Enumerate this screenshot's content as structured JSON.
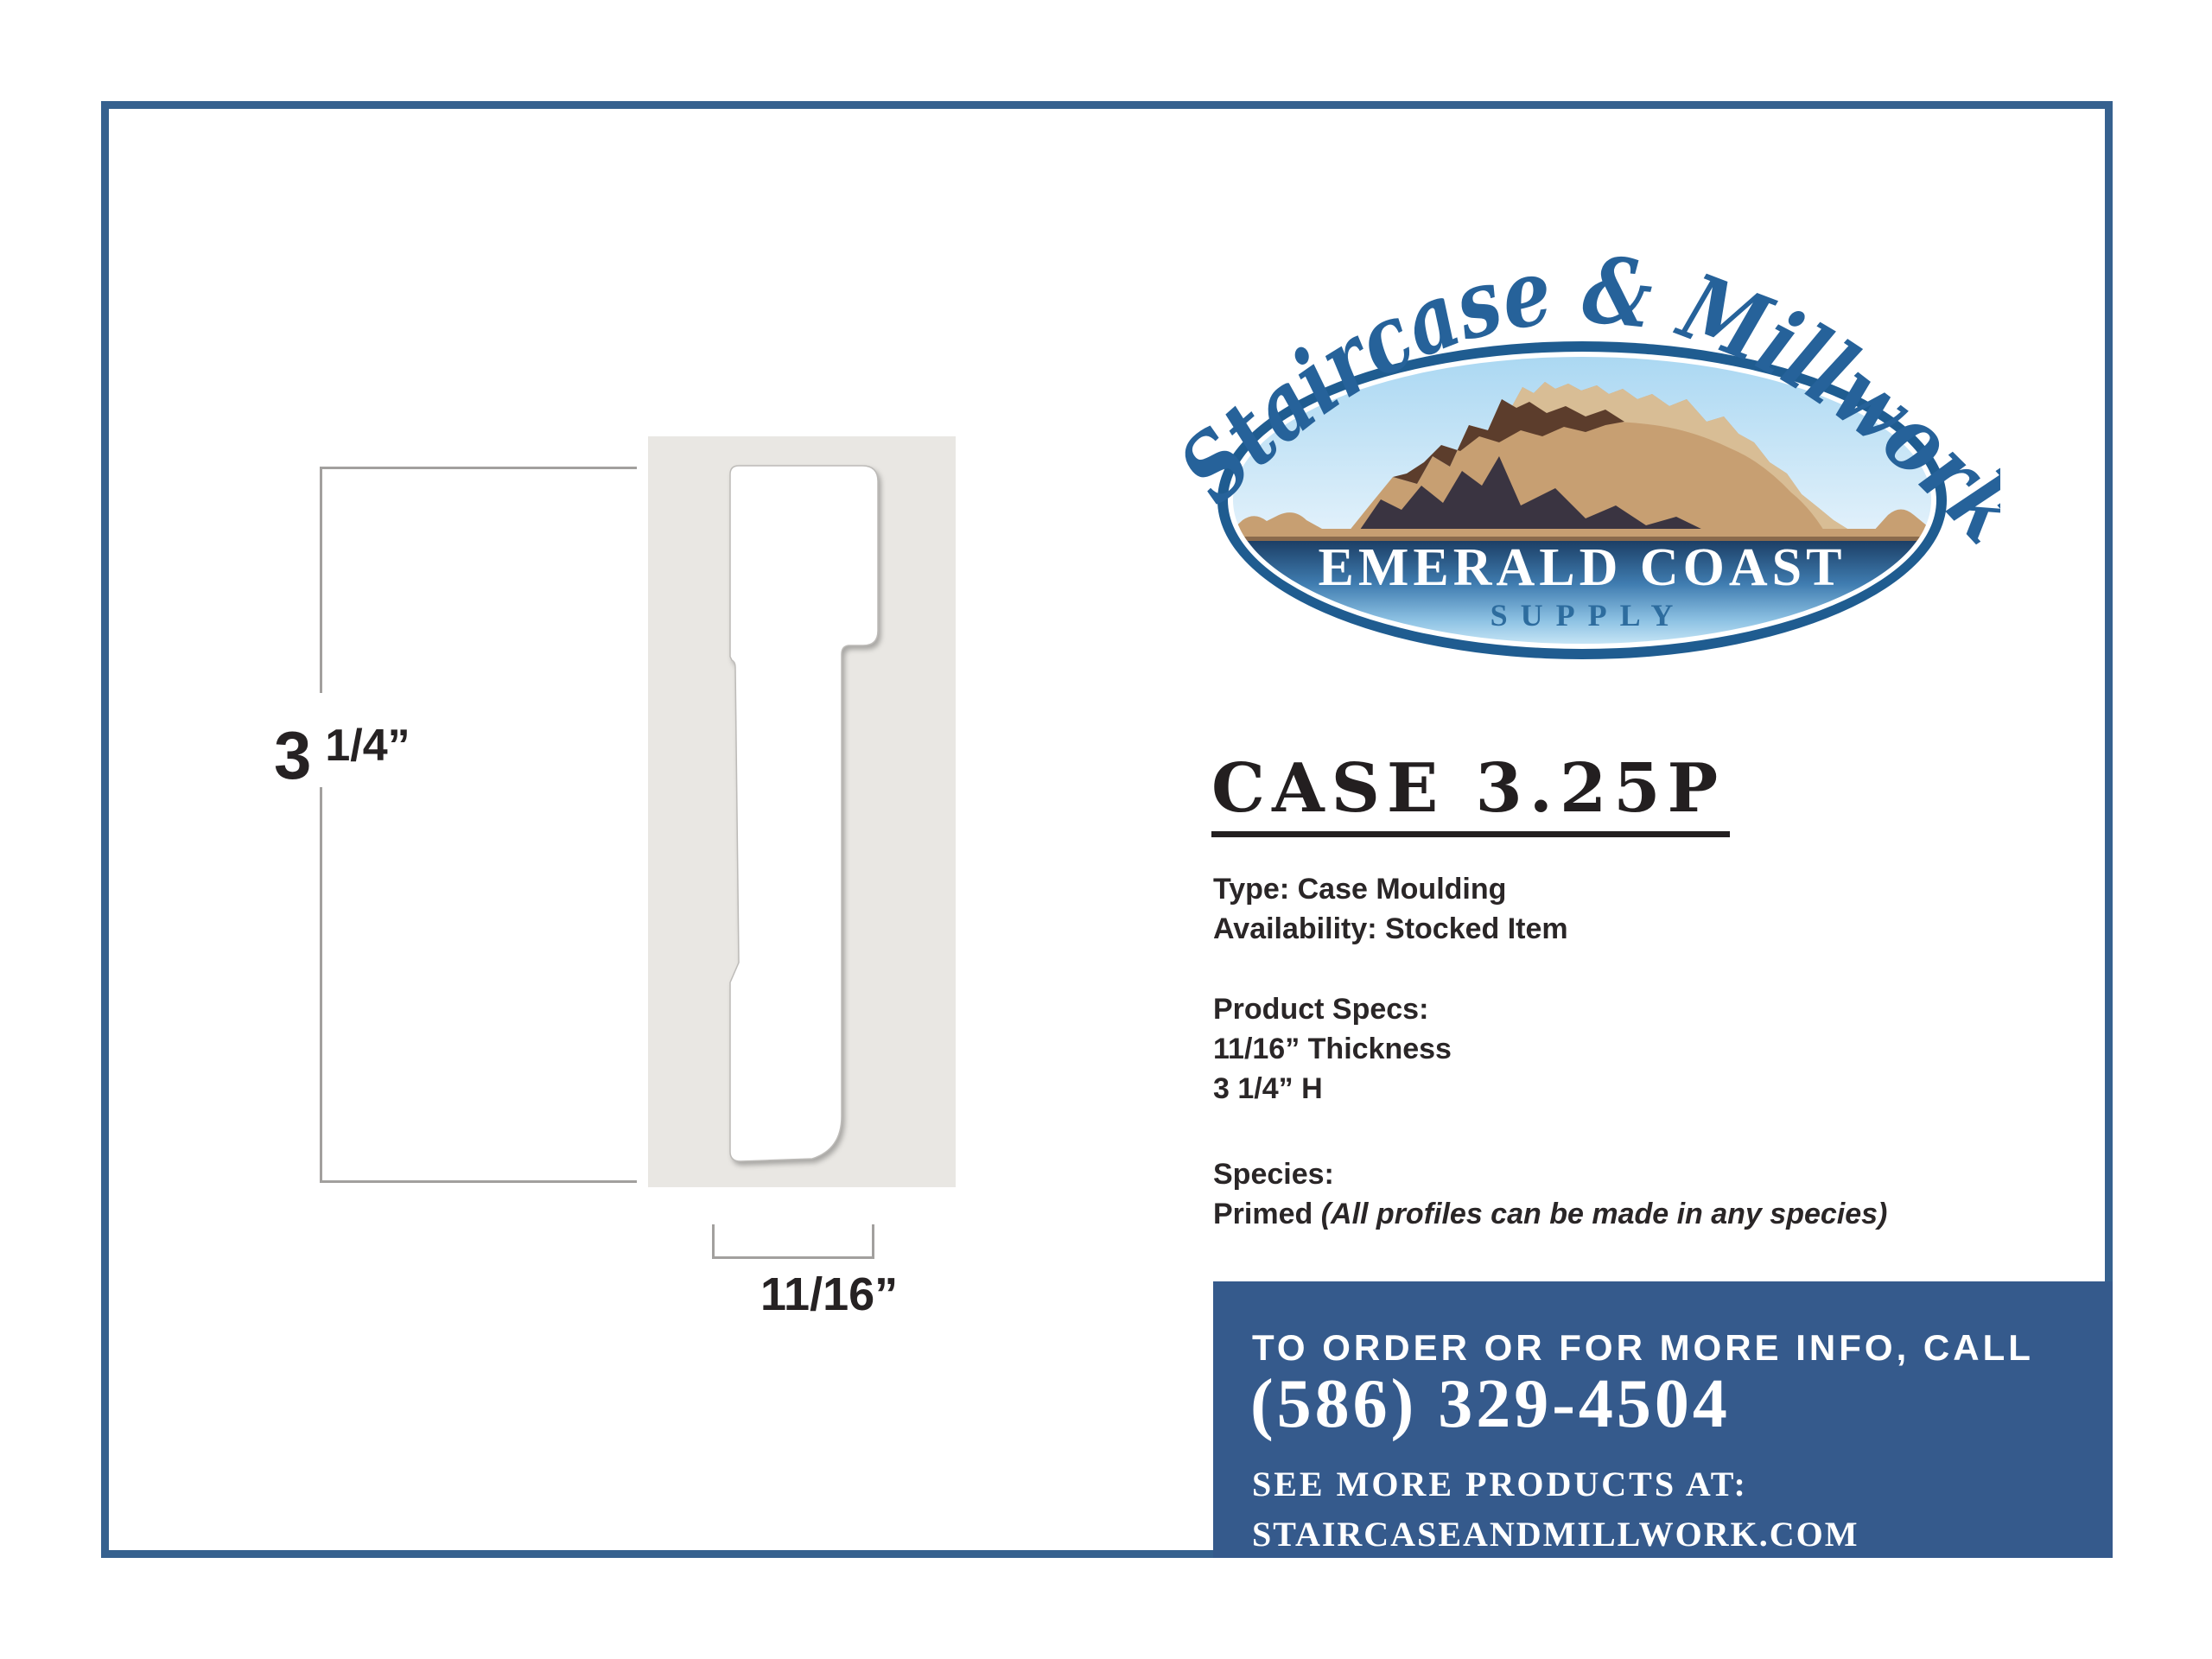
{
  "logo": {
    "arc_text": "Staircase & Millwork",
    "name_line": "EMERALD COAST",
    "supply_line": "SUPPLY"
  },
  "drawing": {
    "height_whole": "3",
    "height_frac": "1/4”",
    "width_label": "11/16”"
  },
  "product": {
    "title": "CASE 3.25P",
    "type_line": "Type: Case Moulding",
    "availability_line": "Availability: Stocked Item",
    "specs_heading": "Product Specs:",
    "thickness_line": "11/16” Thickness",
    "height_line": "3 1/4” H",
    "species_heading": "Species:",
    "species_value": "Primed ",
    "species_note": "(All profiles can be made in any species)"
  },
  "contact": {
    "call_line": "TO ORDER OR FOR MORE INFO, CALL",
    "phone": "(586) 329-4504",
    "see_more_line": "SEE MORE PRODUCTS AT:",
    "website": "STAIRCASEANDMILLWORK.COM"
  },
  "colors": {
    "frame_blue": "#36618F",
    "panel_blue": "#355A8C",
    "logo_ring_blue": "#1F5C90",
    "script_blue": "#26629A",
    "supply_blue": "#2D6C9E",
    "mountain_tan": "#C79F72",
    "mountain_highlight": "#D8BD95",
    "mountain_brown": "#5C3D2C",
    "mountain_dark": "#3A3441",
    "swatch_gray": "#E9E7E3"
  }
}
